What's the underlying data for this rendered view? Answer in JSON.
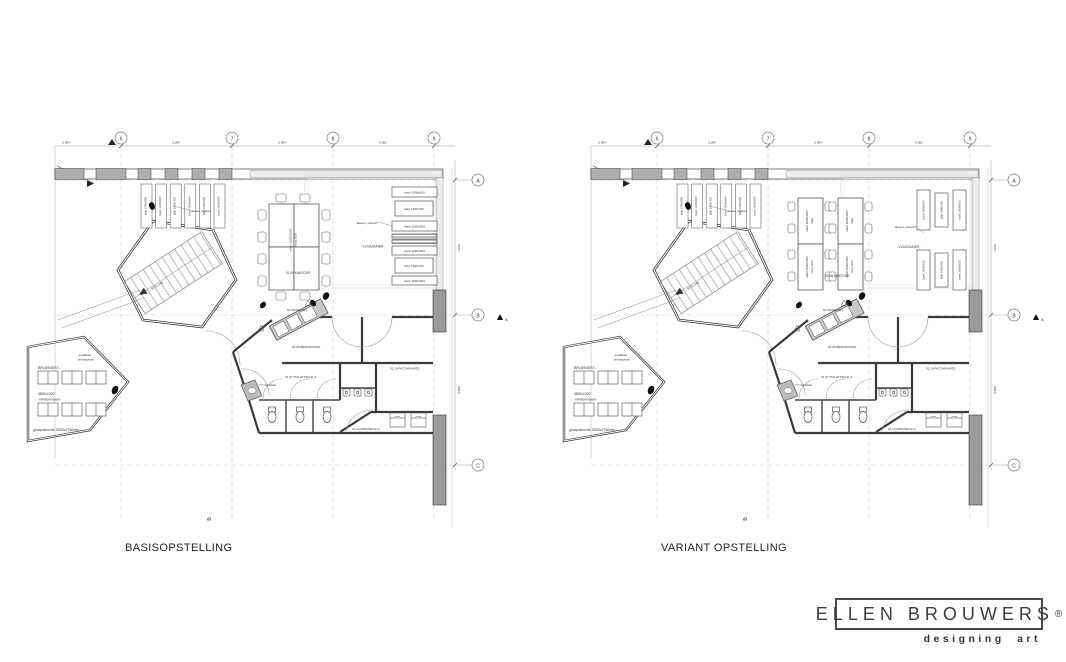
{
  "grid": {
    "cols": [
      "6",
      "7",
      "8",
      "9"
    ],
    "rows": [
      "A",
      "B",
      "C"
    ],
    "col_span": "5.000",
    "row_span_ab": "4.480",
    "row_span_bc": "5.000",
    "section_marker": "A",
    "grid_b": "B"
  },
  "common_labels": {
    "stair": "01.01 trap",
    "screen_note_1": "verrijdbaar",
    "screen_note_2": "beeldscherm",
    "broeinest": "BROEINEST-",
    "broeinest_size": "3600x1200",
    "spreekkamer": "-SPREEKKAMER-",
    "group_note": "groepsfunctie 3500x2750mm",
    "akoest_panel": "akoest. paneel",
    "akoest_panel_q": "akoest. paneel?",
    "vlaszaaier": "-VLASZAAIER-",
    "kantoor": "01.08 KANTOOR",
    "pantry": "01.09 PANTRY",
    "bergruimte": "01.06 BERGRUIMTE",
    "patchruimte": "01.10 PATCHRUIMTE",
    "toiletten": "01.07 TOILETTEN D_A",
    "printer_room": "01.12 PRINTER E.O.",
    "printer": "printer",
    "handdoek": "handdoek",
    "tafel_1200": "tafel 1200x700",
    "bank_1200": "bank 1200x600",
    "bank_1600": "bank 1600x620",
    "tafel_1400": "tafel 1400x700"
  },
  "plans": [
    {
      "title": "BASISOPSTELLING",
      "table_label_1": "tafels 2000x1000",
      "table_label_2": "hoog 1100"
    },
    {
      "title": "VARIANT OPSTELLING",
      "table_laag_1": "tafels 2000x1000",
      "table_laag_2": "laag",
      "table_hoog_1": "tafels 2000x1000",
      "table_hoog_2": "hoog 1100"
    }
  ],
  "logo": {
    "brand": "ELLEN BROUWERS",
    "registered": "®",
    "tagline": "designing art"
  }
}
